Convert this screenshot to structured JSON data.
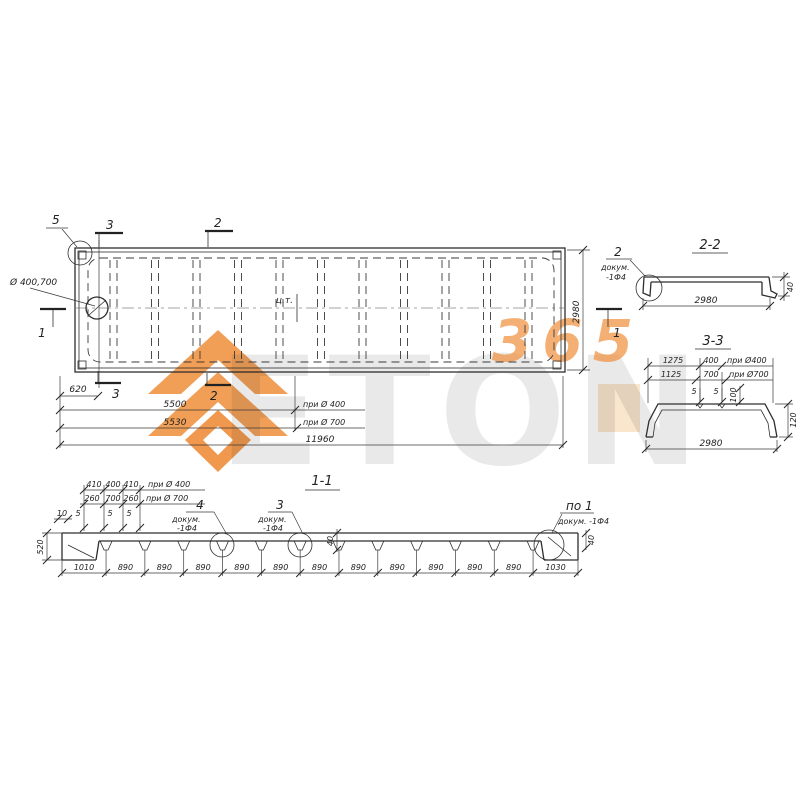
{
  "watermark": {
    "brand": "ETON",
    "suffix": "365",
    "accent": "#F0923F",
    "gray": "#DADADA"
  },
  "plan": {
    "callout5": "5",
    "callout3_top": "3",
    "callout2_top": "2",
    "hole_label": "Ø 400,700",
    "section1_left": "1",
    "section1_right": "1",
    "center_label": "ц.т.",
    "height_dim": "2980",
    "edge_dim": "620",
    "callout3_bottom": "3",
    "callout2_bottom": "2",
    "dim_5500": "5500",
    "note_5500": "при Ø 400",
    "dim_5530": "5530",
    "note_5530": "при Ø 700",
    "total_dim": "11960"
  },
  "section22": {
    "title": "2-2",
    "callout_num": "2",
    "callout_doc": "докум.",
    "callout_ref": "-1Ф4",
    "width_dim": "2980",
    "thickness_dim": "40"
  },
  "section33": {
    "title": "3-3",
    "dim_1275": "1275",
    "dim_400": "400",
    "note_400": "при Ø400",
    "dim_1125": "1125",
    "dim_700": "700",
    "note_700": "при Ø700",
    "gap_left": "5",
    "gap_right": "5",
    "dim_100": "100",
    "dim_120": "120",
    "width_dim": "2980"
  },
  "section11": {
    "title": "1-1",
    "row1": [
      "410",
      "400",
      "410"
    ],
    "note_row1": "при Ø 400",
    "row2": [
      "260",
      "700",
      "260"
    ],
    "note_row2": "при Ø 700",
    "row3": [
      "10",
      "5",
      "5",
      "5"
    ],
    "left_height_dim": "520",
    "rib_depth_a": "40",
    "rib_depth_b": "40",
    "callout4_num": "4",
    "callout4_doc": "докум.",
    "callout4_ref": "-1Ф4",
    "callout3_num": "3",
    "callout3_doc": "докум.",
    "callout3_ref": "-1Ф4",
    "callout_po1": "по 1",
    "callout_po1_doc": "докум. -1Ф4",
    "bottom_dims": [
      "1010",
      "890",
      "890",
      "890",
      "890",
      "890",
      "890",
      "890",
      "890",
      "890",
      "890",
      "890",
      "1030"
    ]
  }
}
